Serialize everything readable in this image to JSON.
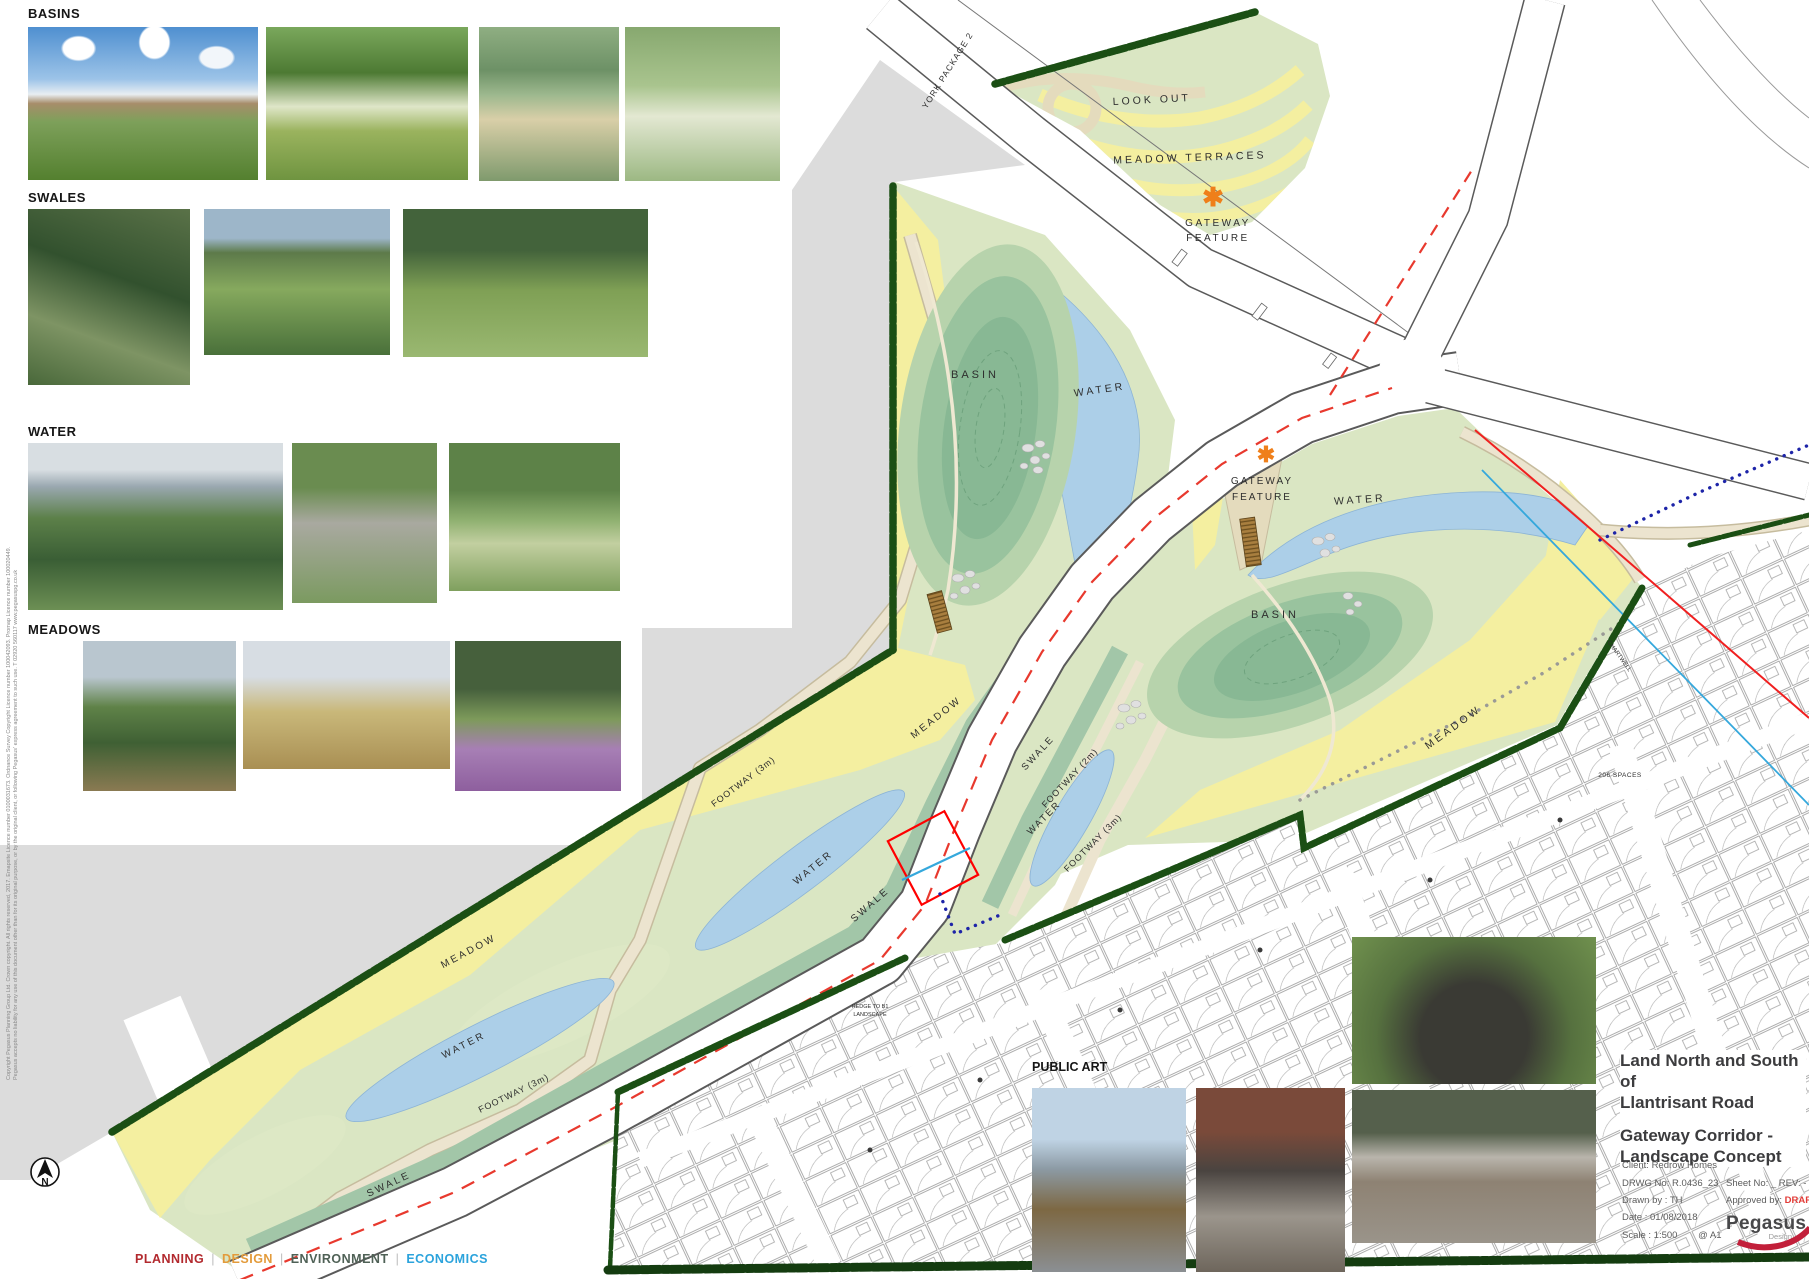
{
  "sheet": {
    "width": 1809,
    "height": 1279,
    "type": "landscape-concept-masterplan"
  },
  "reference_sections": [
    {
      "label": "BASINS",
      "photos": [
        "river-park-with-housing",
        "wet-meadow-boardwalk",
        "stepping-stones-pond",
        "wildflower-basin"
      ]
    },
    {
      "label": "SWALES",
      "photos": [
        "children-in-rock-swale",
        "roadside-grass-swale",
        "tree-lined-flower-swale"
      ]
    },
    {
      "label": "WATER",
      "photos": [
        "children-playing-in-stream",
        "stone-lined-channel",
        "wet-meadow-stream"
      ]
    },
    {
      "label": "MEADOWS",
      "photos": [
        "path-through-meadow",
        "people-in-tall-grass-meadow",
        "purple-wildflower-meadow"
      ]
    },
    {
      "label": "PUBLIC ART",
      "photos": [
        "bird-sculptures",
        "hare-sculptures",
        "climbing-dome-sculpture",
        "badger-sculptures"
      ]
    }
  ],
  "plan": {
    "marker": "✱",
    "labels": [
      {
        "text": "YORK PACKAGE 2"
      },
      {
        "text": "LOOK OUT"
      },
      {
        "text": "MEADOW TERRACES"
      },
      {
        "text": "GATEWAY"
      },
      {
        "text": "FEATURE"
      },
      {
        "text": "BASIN"
      },
      {
        "text": "WATER"
      },
      {
        "text": "GATEWAY"
      },
      {
        "text": "FEATURE"
      },
      {
        "text": "WATER"
      },
      {
        "text": "BASIN"
      },
      {
        "text": "MEADOW"
      },
      {
        "text": "SWALE"
      },
      {
        "text": "FOOTWAY (2m)"
      },
      {
        "text": "WATER"
      },
      {
        "text": "FOOTWAY (3m)"
      },
      {
        "text": "MEADOW"
      },
      {
        "text": "FOOTWAY (3m)"
      },
      {
        "text": "WATER"
      },
      {
        "text": "SWALE"
      },
      {
        "text": "MEADOW"
      },
      {
        "text": "WATER"
      },
      {
        "text": "FOOTWAY (3m)"
      },
      {
        "text": "SWALE"
      },
      {
        "text": "206 SPACES"
      },
      {
        "text": "CHARTWELL"
      },
      {
        "text": "HEDGE TO B1"
      },
      {
        "text": "LANDSCAPE"
      }
    ]
  },
  "title_block": {
    "project_title_line1": "Land North and South of",
    "project_title_line2": "Llantrisant Road",
    "drawing_title_line1": "Gateway Corridor -",
    "drawing_title_line2": "Landscape Concept",
    "client": "Client:   Redrow Homes",
    "drwg_no": "DRWG No: R.0436_23",
    "sheet_no": "Sheet No: _    REV: -",
    "drawn_by": "Drawn by : TH",
    "approved_by": "Approved by:",
    "approved_value": "DRAFT",
    "date": "Date : 01/08/2018",
    "scale": "Scale :   1:500",
    "paper": "@ A1",
    "logo_name": "Pegasus",
    "logo_sub": "Design"
  },
  "footer": {
    "separator": "|",
    "items": [
      {
        "label": "PLANNING",
        "color": "#b2292e"
      },
      {
        "label": "DESIGN",
        "color": "#e39b3b"
      },
      {
        "label": "ENVIRONMENT",
        "color": "#4f6156"
      },
      {
        "label": "ECONOMICS",
        "color": "#2ba3dc"
      }
    ]
  },
  "compass": {
    "letter": "N"
  },
  "copyright": {
    "line1": "Copyright Pegasus Planning Group Ltd. Crown copyright. All rights reserved, 2017. Emapsite Licence number 0100031673. Ordnance Survey Copyright Licence number 100042093. Promap Licence number 100020449.",
    "line2": "Pegasus accepts no liability for any use of this document other than for its original purpose, or by the original client, or following Pegasus' express agreement to such use.   T 02920 560117   www.pegasuspg.co.uk"
  },
  "colors": {
    "meadow_yellow": "#f4efa0",
    "footway_cream": "#ece4cf",
    "water_blue": "#accfe8",
    "swale_green": "#a2c6a8",
    "basin_green": "#88b894",
    "hedge_green": "#1b4f14",
    "existing_grey": "#dcdcdc",
    "boundary_red": "#e8392e",
    "utility_cyan": "#35a8dc",
    "navy_dots": "#1d24a8",
    "gateway_orange": "#ef7f1a"
  }
}
